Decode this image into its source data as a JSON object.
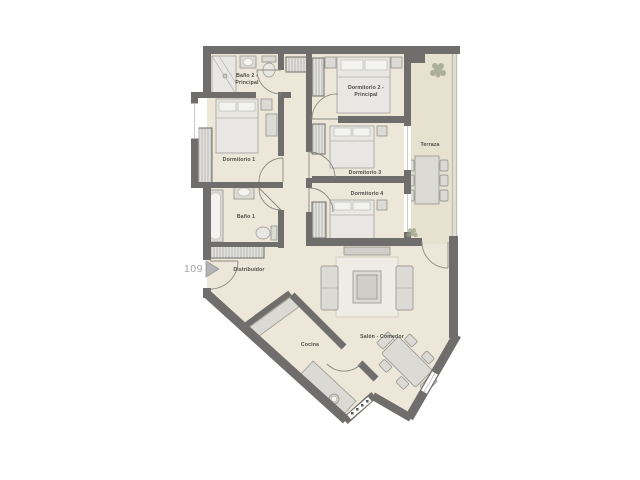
{
  "palette": {
    "wall": "#6f6e6c",
    "floor": "#ece7d8",
    "terrace_floor": "#e7e2cf",
    "label": "#4d4b47",
    "unit_number": "#a3a3a3",
    "plant": "#99a086"
  },
  "unit": {
    "number": "109"
  },
  "rooms": {
    "bano2": {
      "line1": "Baño 2 -",
      "line2": "Principal"
    },
    "dormitorio1": {
      "label": "Dormitorio 1"
    },
    "dormitorio2": {
      "line1": "Dormitorio 2 -",
      "line2": "Principal"
    },
    "dormitorio3": {
      "label": "Dormitorio 3"
    },
    "dormitorio4": {
      "label": "Dormitorio 4"
    },
    "bano1": {
      "label": "Baño 1"
    },
    "distribuidor": {
      "label": "Distribuidor"
    },
    "terraza": {
      "label": "Terraza"
    },
    "salon": {
      "label": "Salón - Comedor"
    },
    "cocina": {
      "label": "Cocina"
    }
  }
}
